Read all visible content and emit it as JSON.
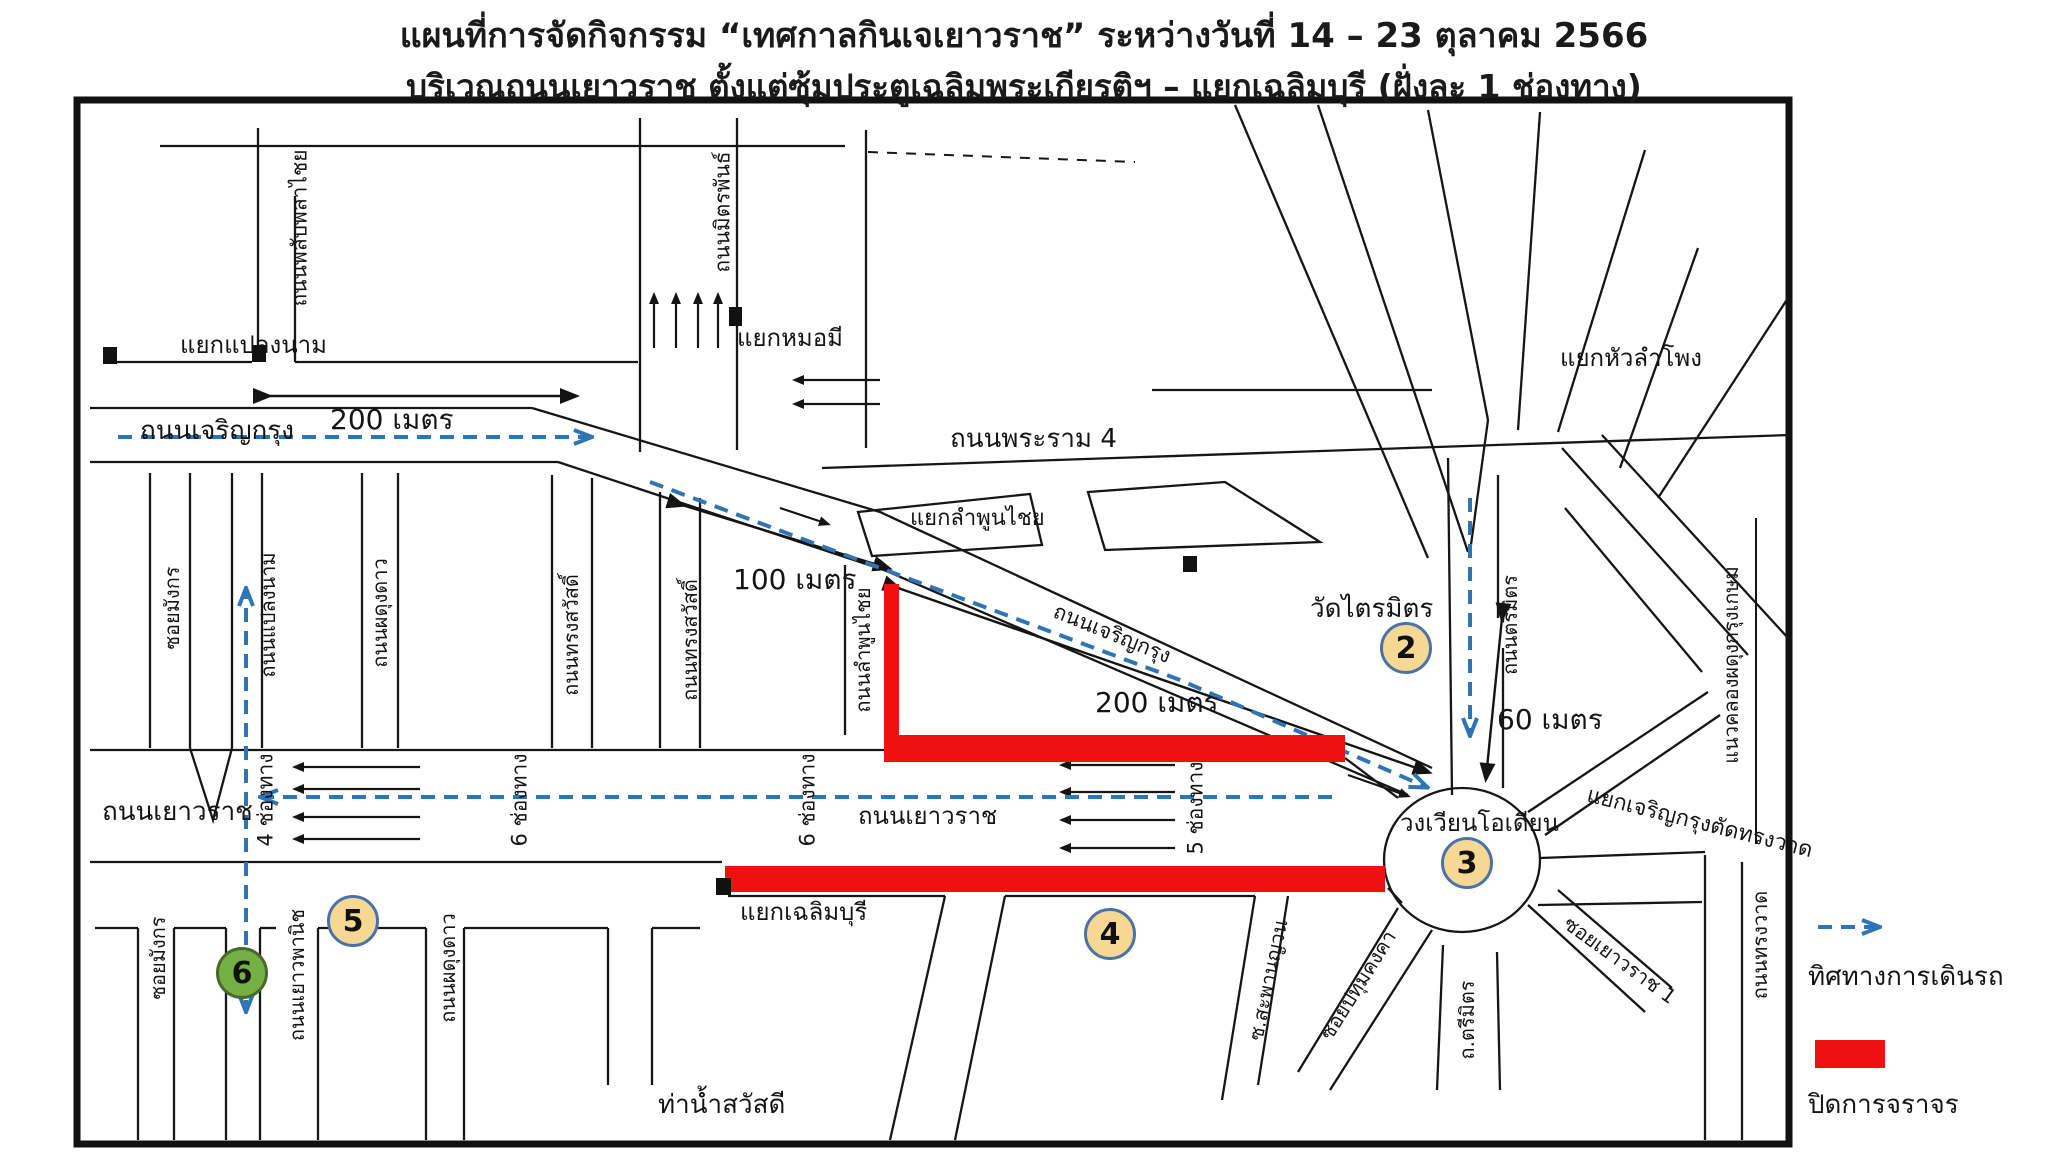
{
  "title": {
    "line1": "แผนที่การจัดกิจกรรม “เทศกาลกินเจเยาวราช” ระหว่างวันที่ 14 – 23 ตุลาคม 2566",
    "line2": "บริเวณถนนเยาวราช ตั้งแต่ซุ้มประตูเฉลิมพระเกียรติฯ – แยกเฉลิมบุรี (ฝั่งละ 1 ช่องทาง)"
  },
  "colors": {
    "route_blue": "#2E75B6",
    "closure_red": "#EE1111",
    "marker_fill": "#F6D793",
    "marker_ring": "#4a72a8",
    "marker6_fill": "#74b043",
    "line_black": "#141414"
  },
  "map": {
    "labels": {
      "yaek_plaeng_nam": "แยกแปลงนาม",
      "phlapphla_chai": "ถนนพลับพลาไชย",
      "mit_phan": "ถนนมิตรพันธ์",
      "yaek_mo_mi": "แยกหมอมี",
      "charoen_krung_west": "ถนนเจริญกรุง",
      "meters200_west": "200 เมตร",
      "rama4": "ถนนพระราม 4",
      "yaek_lamphun_chai": "แยกลำพูนไชย",
      "lamphun_chai_rd": "ถนนลำพูนไชย",
      "meters100": "100 เมตร",
      "charoen_krung_diag": "ถนนเจริญกรุง",
      "wat_traimit": "วัดไตรมิตร",
      "meters200_east": "200 เมตร",
      "meters60": "60 เมตร",
      "trimit_rd": "ถนนตรีมิตร",
      "odeon": "วงเวียนโอเดียน",
      "yaek_hua_lamphong": "แยกหัวลำโพง",
      "yaek_ck_songwat": "แยกเจริญกรุงตัดทรงวาด",
      "khlong_kasem": "แนวคลองผดุงกรุงเกษม",
      "yaowarat_west": "ถนนเยาวราช",
      "yaowarat_mid": "ถนนเยาวราช",
      "lane4": "4 ช่องทาง",
      "lane6a": "6 ช่องทาง",
      "lane6b": "6 ช่องทาง",
      "lane5": "5 ช่องทาง",
      "soi_mangkon_n": "ซอยมังกร",
      "plaeng_nam_rd": "ถนนแปลงนาม",
      "phadung_dao_n": "ถนนผดุงดาว",
      "song_sawat_1": "ถนนทรงสวัสดิ์",
      "song_sawat_2": "ถนนทรงสวัสดิ์",
      "yaek_chalermburi": "แยกเฉลิมบุรี",
      "soi_mangkon_s": "ซอยมังกร",
      "yaowa_phanit": "ถนนเยาวพานิช",
      "phadung_dao_s": "ถนนผดุงดาว",
      "tha_nam_sawatdi": "ท่าน้ำสวัสดี",
      "saphan_yuan": "ซ.สะพานญวน",
      "pathum_khongkha": "ซอยปทุมคงคา",
      "trimit_short": "ถ.ตรีมิตร",
      "soi_yaowarat1": "ซอยเยาวราช 1",
      "song_wat": "ถนนทรงวาด"
    },
    "markers": {
      "c2": "2",
      "c3": "3",
      "c4": "4",
      "c5": "5",
      "c6": "6"
    }
  },
  "legend": {
    "direction_label": "ทิศทางการเดินรถ",
    "closed_label": "ปิดการจราจร"
  }
}
